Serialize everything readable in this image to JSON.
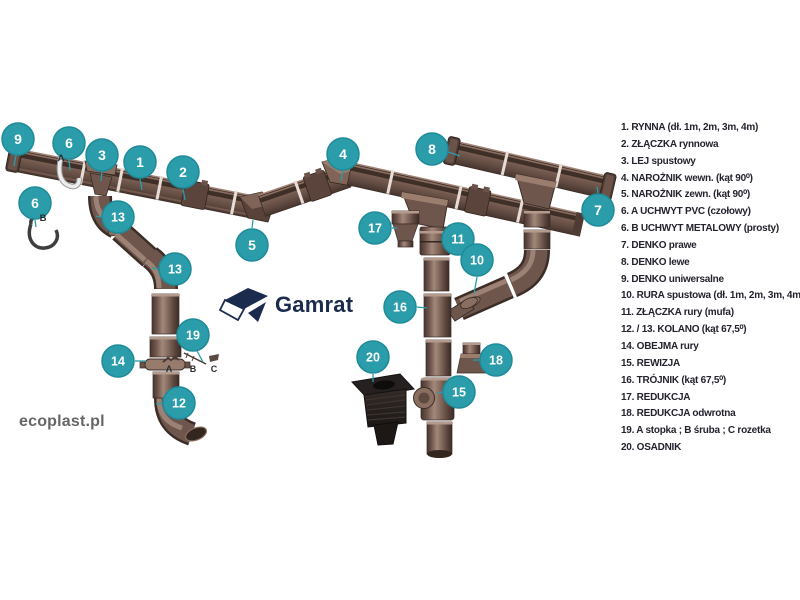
{
  "brand": {
    "logo_text": "Gamrat",
    "watermark": "ecoplast.pl"
  },
  "colors": {
    "accent_teal": "#2B9CAA",
    "accent_teal_dark": "#1F8B99",
    "pipe_brown": "#6E564C",
    "logo_navy": "#1B2B4E",
    "legend_text": "#23232E",
    "watermark_gray": "#666666",
    "dark_part": "#262020"
  },
  "legend": {
    "items": [
      {
        "num": "1.",
        "label": "RYNNA (dł. 1m, 2m, 3m, 4m)"
      },
      {
        "num": "2.",
        "label": "ZŁĄCZKA rynnowa"
      },
      {
        "num": "3.",
        "label": "LEJ spustowy"
      },
      {
        "num": "4.",
        "label": "NAROŻNIK wewn. (kąt 90⁰)"
      },
      {
        "num": "5.",
        "label": "NAROŻNIK zewn. (kąt 90⁰)"
      },
      {
        "num": "6.",
        "label": "A UCHWYT PVC (czołowy)"
      },
      {
        "num": "6.",
        "label": "B UCHWYT METALOWY (prosty)"
      },
      {
        "num": "7.",
        "label": "DENKO prawe"
      },
      {
        "num": "8.",
        "label": "DENKO lewe"
      },
      {
        "num": "9.",
        "label": "DENKO uniwersalne"
      },
      {
        "num": "10.",
        "label": "RURA spustowa (dł. 1m, 2m, 3m, 4m)"
      },
      {
        "num": "11.",
        "label": "ZŁĄCZKA rury (mufa)"
      },
      {
        "num": "12. / 13.",
        "label": "KOLANO (kąt 67,5⁰)"
      },
      {
        "num": "14.",
        "label": "OBEJMA rury"
      },
      {
        "num": "15.",
        "label": "REWIZJA"
      },
      {
        "num": "16.",
        "label": "TRÓJNIK (kąt 67,5⁰)"
      },
      {
        "num": "17.",
        "label": "REDUKCJA"
      },
      {
        "num": "18.",
        "label": "REDUKCJA odwrotna"
      },
      {
        "num": "19.",
        "label": "A stopka ; B śruba ; C rozetka"
      },
      {
        "num": "20.",
        "label": "OSADNIK"
      }
    ]
  },
  "callouts": [
    {
      "n": "9",
      "x": 18,
      "y": 139,
      "line": [
        16,
        155,
        14,
        166
      ]
    },
    {
      "n": "6",
      "x": 69,
      "y": 143,
      "tag": "A",
      "tagx": 61,
      "tagy": 161,
      "line": [
        69,
        160,
        70,
        170
      ]
    },
    {
      "n": "3",
      "x": 102,
      "y": 155,
      "line": [
        102,
        172,
        101,
        181
      ]
    },
    {
      "n": "1",
      "x": 140,
      "y": 162,
      "line": [
        140,
        179,
        142,
        190
      ]
    },
    {
      "n": "2",
      "x": 183,
      "y": 172,
      "line": [
        183,
        189,
        185,
        200
      ]
    },
    {
      "n": "13",
      "x": 118,
      "y": 217,
      "line": [
        101,
        217,
        96,
        216
      ]
    },
    {
      "n": "6",
      "x": 35,
      "y": 203,
      "tag": "B",
      "tagx": 43,
      "tagy": 221,
      "line": [
        35,
        220,
        36,
        227
      ]
    },
    {
      "n": "13",
      "x": 175,
      "y": 269,
      "line": [
        158,
        269,
        152,
        268
      ]
    },
    {
      "n": "5",
      "x": 252,
      "y": 245,
      "line": [
        252,
        228,
        253,
        220
      ]
    },
    {
      "n": "4",
      "x": 343,
      "y": 154,
      "line": [
        343,
        171,
        341,
        181
      ]
    },
    {
      "n": "8",
      "x": 432,
      "y": 149,
      "line": [
        448,
        152,
        460,
        156
      ]
    },
    {
      "n": "7",
      "x": 598,
      "y": 210,
      "line": [
        598,
        193,
        597,
        187
      ]
    },
    {
      "n": "17",
      "x": 375,
      "y": 228,
      "line": [
        392,
        228,
        397,
        228
      ]
    },
    {
      "n": "11",
      "x": 458,
      "y": 239,
      "line": [
        443,
        239,
        451,
        240
      ]
    },
    {
      "n": "10",
      "x": 477,
      "y": 260,
      "line": [
        477,
        277,
        474,
        294
      ]
    },
    {
      "n": "16",
      "x": 400,
      "y": 307,
      "line": [
        417,
        307,
        427,
        308
      ]
    },
    {
      "n": "19",
      "x": 193,
      "y": 335,
      "line": [
        197,
        351,
        203,
        362
      ]
    },
    {
      "n": "14",
      "x": 118,
      "y": 361,
      "line": [
        135,
        361,
        146,
        361
      ]
    },
    {
      "n": "20",
      "x": 373,
      "y": 357,
      "line": [
        373,
        374,
        373,
        382
      ]
    },
    {
      "n": "12",
      "x": 179,
      "y": 403,
      "line": [
        163,
        403,
        156,
        404
      ]
    },
    {
      "n": "15",
      "x": 459,
      "y": 392,
      "line": [
        443,
        392,
        437,
        393
      ]
    },
    {
      "n": "18",
      "x": 496,
      "y": 360,
      "line": [
        480,
        360,
        473,
        360
      ]
    }
  ],
  "part_labels": [
    {
      "t": "A",
      "x": 169,
      "y": 372
    },
    {
      "t": "B",
      "x": 193,
      "y": 372
    },
    {
      "t": "C",
      "x": 214,
      "y": 372
    }
  ]
}
